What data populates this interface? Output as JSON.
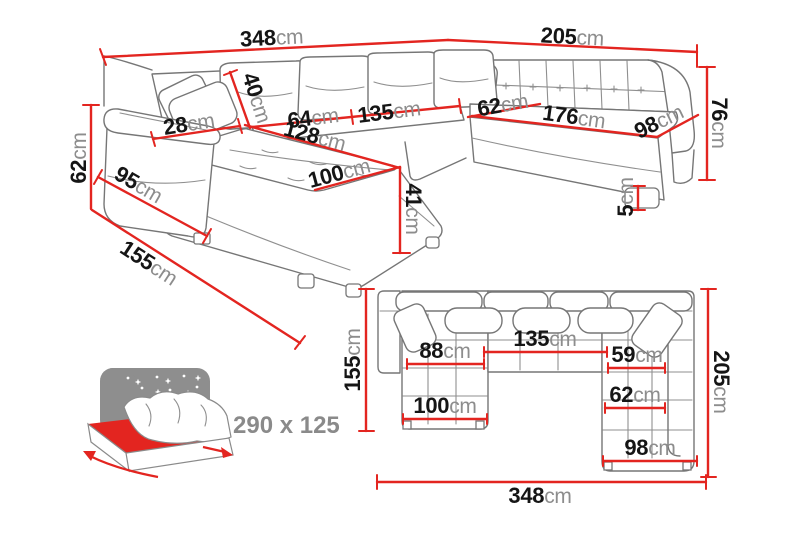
{
  "colors": {
    "dimension_red": "#e32520",
    "sketch_gray": "#767676",
    "number_black": "#151515",
    "unit_gray": "#8d8d8d",
    "icon_gray": "#8e8e8e"
  },
  "perspective_view": {
    "dimensions": {
      "total_width": {
        "value": "348",
        "unit": "cm"
      },
      "right_width": {
        "value": "205",
        "unit": "cm"
      },
      "backrest_height": {
        "value": "76",
        "unit": "cm"
      },
      "armrest_height": {
        "value": "62",
        "unit": "cm"
      },
      "armrest_depth": {
        "value": "95",
        "unit": "cm"
      },
      "chaise_depth": {
        "value": "155",
        "unit": "cm"
      },
      "armrest_top_width": {
        "value": "28",
        "unit": "cm"
      },
      "back_cushion_height": {
        "value": "40",
        "unit": "cm"
      },
      "seat_front_left": {
        "value": "64",
        "unit": "cm"
      },
      "seat_front_middle": {
        "value": "135",
        "unit": "cm"
      },
      "chaise_length": {
        "value": "128",
        "unit": "cm"
      },
      "chaise_width": {
        "value": "100",
        "unit": "cm"
      },
      "seat_height": {
        "value": "41",
        "unit": "cm"
      },
      "corner_seat_width": {
        "value": "62",
        "unit": "cm"
      },
      "right_seat_length": {
        "value": "176",
        "unit": "cm"
      },
      "right_seat_depth": {
        "value": "98",
        "unit": "cm"
      },
      "leg_height": {
        "value": "5",
        "unit": "cm"
      }
    }
  },
  "plan_view": {
    "dimensions": {
      "left_depth": {
        "value": "155",
        "unit": "cm"
      },
      "right_depth": {
        "value": "205",
        "unit": "cm"
      },
      "chaise_width": {
        "value": "88",
        "unit": "cm"
      },
      "middle_width": {
        "value": "135",
        "unit": "cm"
      },
      "right_inner_width": {
        "value": "59",
        "unit": "cm"
      },
      "chaise_outer_width": {
        "value": "100",
        "unit": "cm"
      },
      "right_mid_width": {
        "value": "62",
        "unit": "cm"
      },
      "right_outer_width": {
        "value": "98",
        "unit": "cm"
      },
      "total_width": {
        "value": "348",
        "unit": "cm"
      }
    }
  },
  "sleeping_function": {
    "dimensions_label": "290 x 125"
  }
}
